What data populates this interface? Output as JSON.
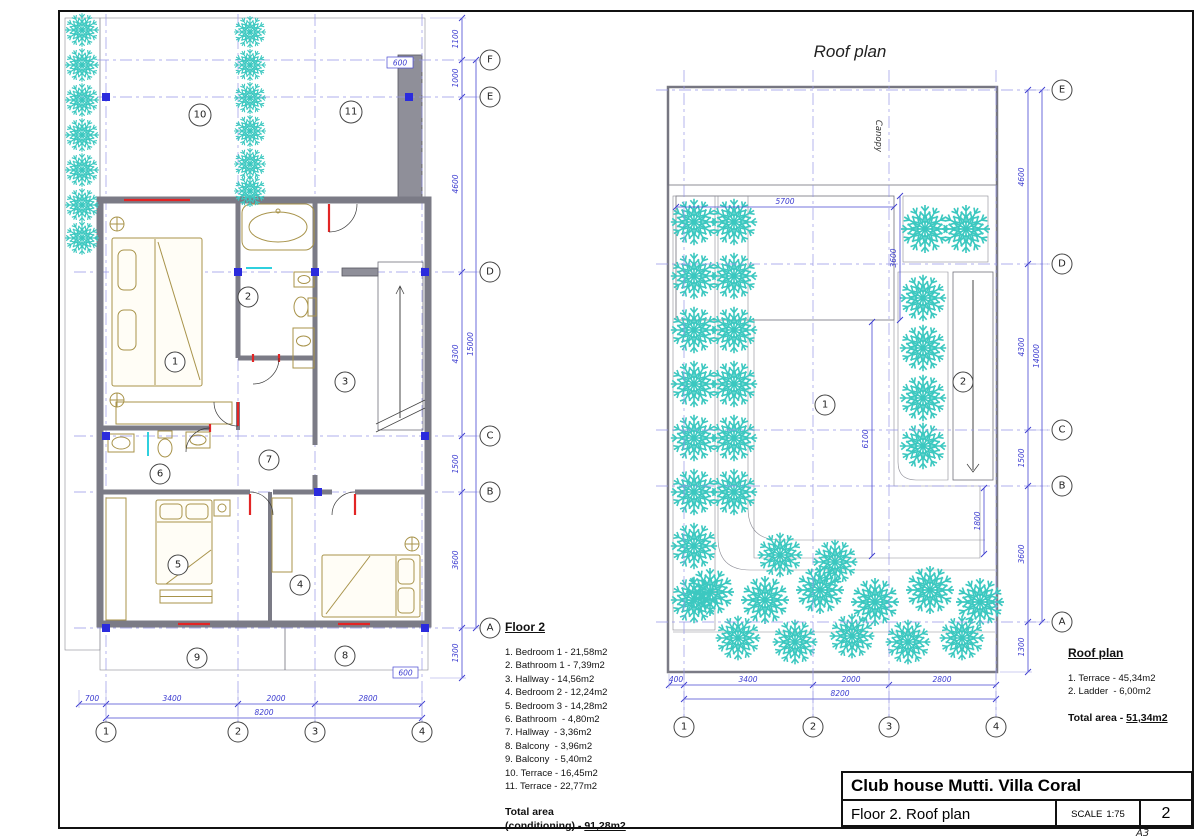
{
  "colors": {
    "dimension_blue": "#3b3bd0",
    "grid_marker_blue": "#2b2bdd",
    "plant_teal": "#3cc8c0",
    "wall_gray": "#8f8f99",
    "furniture_tan": "#a8934a",
    "door_red": "#e22525",
    "fixture_cyan": "#2fd0de"
  },
  "sheet": {
    "format_label": "A3"
  },
  "title_block": {
    "project": "Club house Mutti. Villa Coral",
    "sheet_title": "Floor 2. Roof plan",
    "scale_label": "SCALE",
    "scale_value": "1:75",
    "sheet_number": "2"
  },
  "floor2": {
    "room_labels": [
      "1",
      "2",
      "3",
      "4",
      "5",
      "6",
      "7",
      "8",
      "9",
      "10",
      "11"
    ],
    "grid_rows": [
      "F",
      "E",
      "D",
      "C",
      "B",
      "A"
    ],
    "grid_cols": [
      "1",
      "2",
      "3",
      "4"
    ],
    "dims_right": [
      "1100",
      "1000",
      "4600",
      "4300",
      "1500",
      "3600",
      "1300"
    ],
    "dim_total_right": "15000",
    "dims_bottom": [
      "700",
      "3400",
      "2000",
      "2800"
    ],
    "dim_total_bottom": "8200",
    "dim_wall_top": "600",
    "dim_wall_bottom": "600",
    "legend": {
      "heading": "Floor 2",
      "items": [
        "1. Bedroom 1 - 21,58m2",
        "2. Bathroom 1 - 7,39m2",
        "3. Hallway - 14,56m2",
        "4. Bedroom 2 - 12,24m2",
        "5. Bedroom 3 - 14,28m2",
        "6. Bathroom  - 4,80m2",
        "7. Hallway  - 3,36m2",
        "8. Balcony  - 3,96m2",
        "9. Balcony  - 5,40m2",
        "10. Terrace - 16,45m2",
        "11. Terrace - 22,77m2"
      ],
      "total_label": "Total area",
      "total_prefix": "(conditioning) - ",
      "total_value": "91,28m2"
    }
  },
  "roof": {
    "title": "Roof plan",
    "canopy_label": "Canopy",
    "room_labels": [
      "1",
      "2"
    ],
    "grid_rows": [
      "E",
      "D",
      "C",
      "B",
      "A"
    ],
    "grid_cols": [
      "1",
      "2",
      "3",
      "4"
    ],
    "dims_right": [
      "4600",
      "4300",
      "1500",
      "3600",
      "1300"
    ],
    "dim_total_right": "14000",
    "dims_bottom": [
      "400",
      "3400",
      "2000",
      "2800"
    ],
    "dim_total_bottom": "8200",
    "dim_deck_width": "5700",
    "dim_deck_height": "3600",
    "dim_terrace_height": "6100",
    "dim_stair_drop": "1800",
    "legend": {
      "heading": "Roof plan",
      "items": [
        "1. Terrace - 45,34m2",
        "2. Ladder  - 6,00m2"
      ],
      "total_prefix": "Total area - ",
      "total_value": "51,34m2"
    }
  }
}
